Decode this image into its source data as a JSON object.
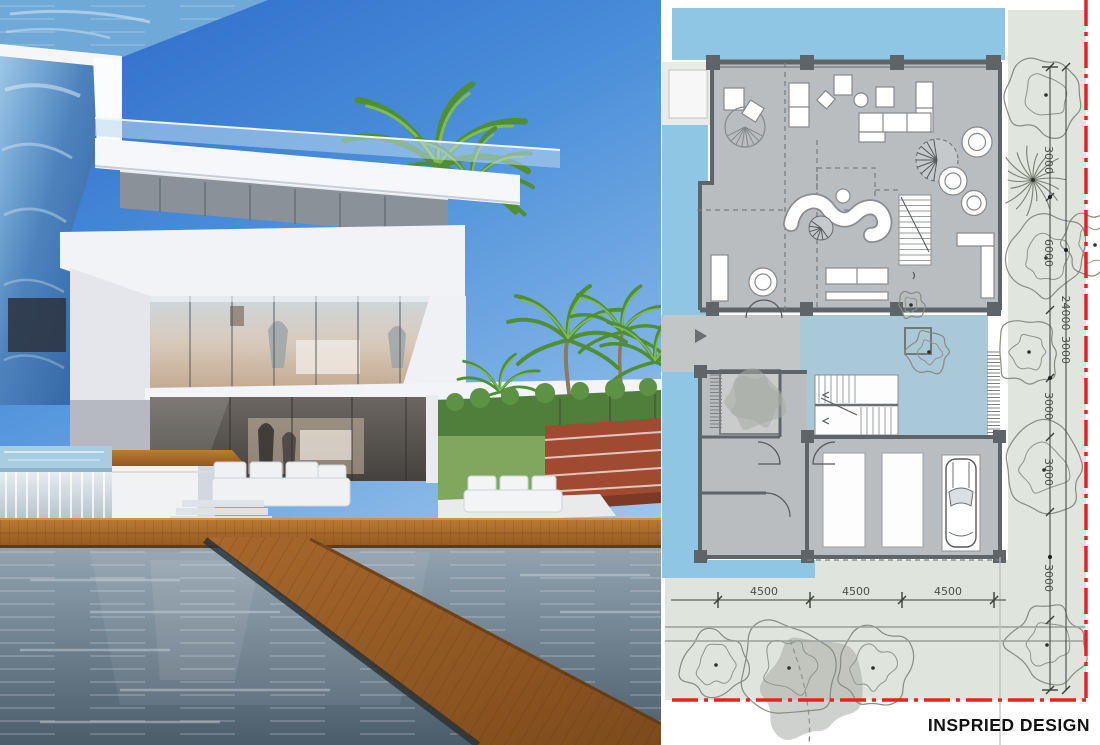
{
  "plan": {
    "title": "INSPRIED DESIGN",
    "dims_bottom": [
      "4500",
      "4500",
      "4500"
    ],
    "dims_right": [
      "3000",
      "6000",
      "24000",
      "3000",
      "3000",
      "3000",
      "3000"
    ],
    "colors": {
      "pool_blue": "#8ec6e4",
      "courtyard_blue": "#a9c8d8",
      "floor_gray": "#b9bdbf",
      "wall_dark": "#5f6468",
      "site_green": "#e0e5dd",
      "boundary_red": "#e8231d",
      "dim_text": "#4a4f49"
    }
  },
  "photo": {
    "colors": {
      "sky_top": "#2c67c9",
      "sky_light": "#a6cbee",
      "glass_pool_wall": "#3f76b4",
      "building_white": "#f2f3f6",
      "deck_wood": "#b5742f",
      "pool_water": "#6e7f8d",
      "palm_green": "#5f9e3d",
      "tennis_court": "#a04a32"
    }
  }
}
